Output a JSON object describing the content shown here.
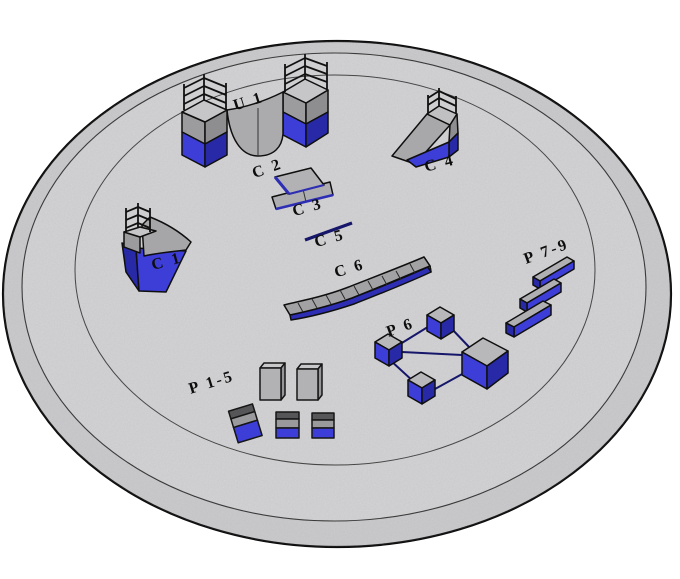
{
  "scene": {
    "description": "Isometric 3D rendering of a circular skatepark platform with labeled ramp and obstacle modules",
    "background_color": "#ffffff"
  },
  "platform": {
    "shape": "circular concrete slab with two concentric edge rings",
    "surface_color": "#d4d4d6",
    "rim_color": "#cbcbcd",
    "outline_color": "#0d0d0d"
  },
  "palette": {
    "equipment_gray": "#ababad",
    "equipment_gray_light": "#c6c6c8",
    "equipment_gray_dark": "#8e8e90",
    "blue_front": "#3d3ed8",
    "blue_side": "#2829a6",
    "rail_navy": "#16166a",
    "dark_lid": "#565658",
    "label_color": "#0d0d0d"
  },
  "items": [
    {
      "key": "u1",
      "label": "U 1",
      "type": "halfpipe of two facing quarterpipes with railed platforms"
    },
    {
      "key": "c1",
      "label": "C 1",
      "type": "quarterpipe ramp with platform railing"
    },
    {
      "key": "c2",
      "label": "C 2",
      "type": "bank panel"
    },
    {
      "key": "c3",
      "label": "C 3",
      "type": "double bank panel"
    },
    {
      "key": "c4",
      "label": "C 4",
      "type": "wedge bank ramp with platform railing"
    },
    {
      "key": "c5",
      "label": "C 5",
      "type": "flat grind rail"
    },
    {
      "key": "c6",
      "label": "C 6",
      "type": "long segmented wave ledge"
    },
    {
      "key": "p15",
      "label": "P 1-5",
      "type": "set of five boxes and pedestals"
    },
    {
      "key": "p6",
      "label": "P 6",
      "type": "cube cluster linked by grind rails"
    },
    {
      "key": "p79",
      "label": "P 7-9",
      "type": "three parallel grind boxes"
    }
  ]
}
